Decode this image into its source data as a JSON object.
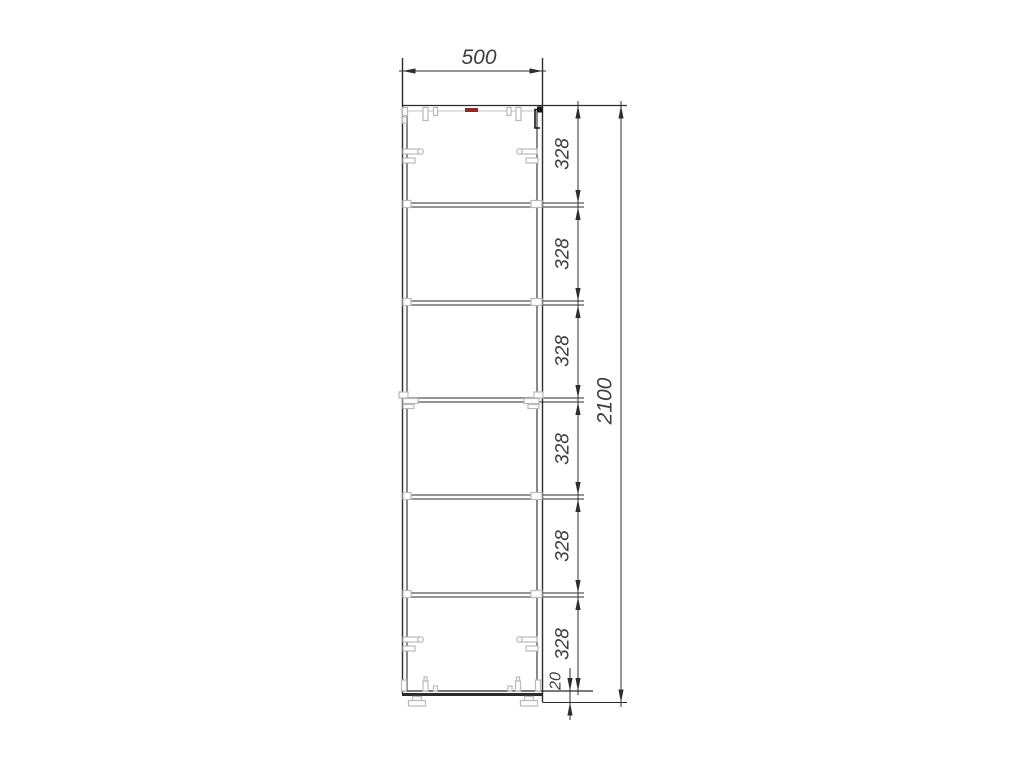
{
  "drawing": {
    "width_label": "500",
    "section_labels": [
      "328",
      "328",
      "328",
      "328",
      "328",
      "328"
    ],
    "overall_height_label": "2100",
    "plinth_height_label": "20"
  },
  "colors": {
    "outline": "#2b2b2b",
    "dimension_lines": "#2e2e2e",
    "hardware_gray": "#b9b9b9",
    "accent_mark_red": "#8e2727",
    "label_text": "#3d3d3d"
  }
}
